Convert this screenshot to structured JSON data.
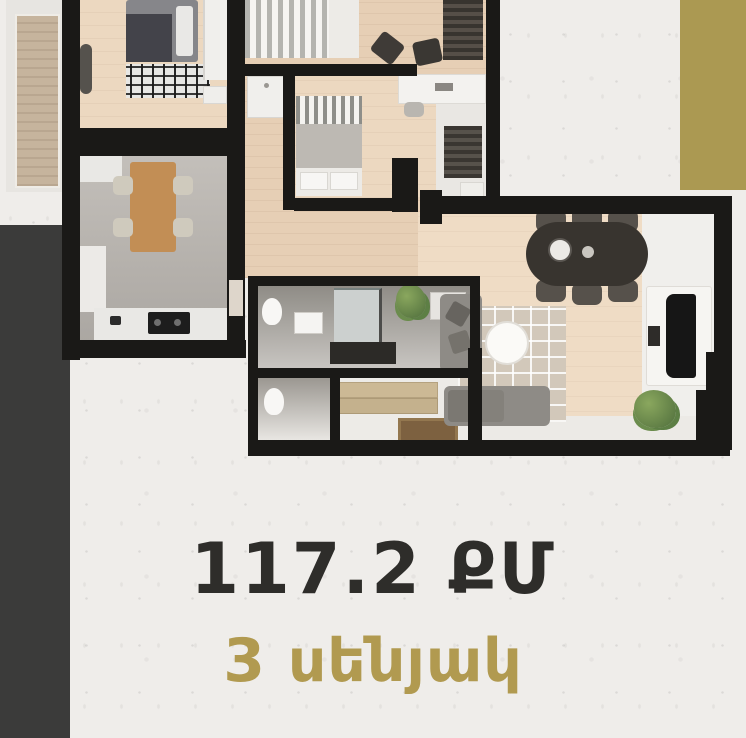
{
  "caption": {
    "area": "117.2 ՔՄ",
    "rooms": "3 սենյակ"
  },
  "colors": {
    "background": "#efedea",
    "accent_gold": "#ab9952",
    "side_band_dark": "#3b3b3a",
    "plan_walls": "#1a1917",
    "area_text": "#2e2d2a",
    "rooms_text": "#b19a50",
    "wood_floor": "#ecd8c0",
    "kitchen_floor": "#b7b3ae"
  }
}
